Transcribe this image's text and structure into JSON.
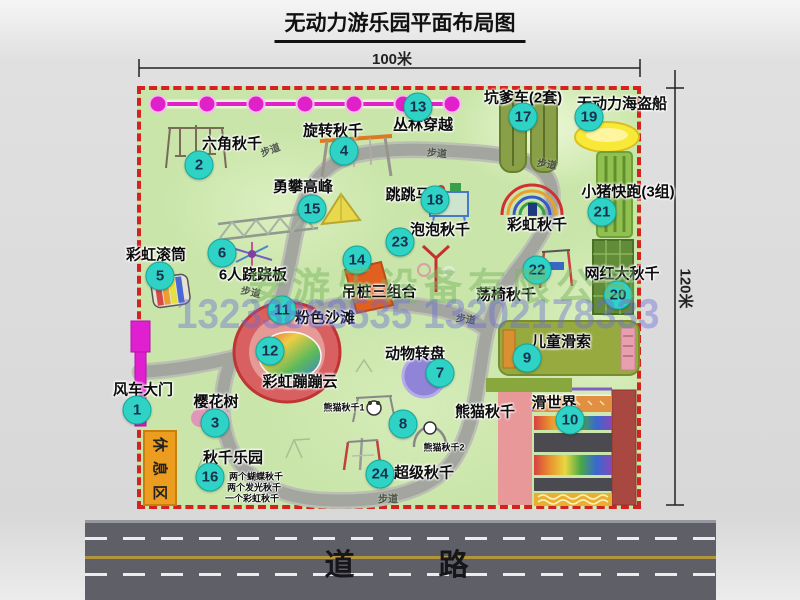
{
  "title": "无动力游乐园平面布局图",
  "dimensions": {
    "width_label": "100米",
    "height_label": "120米"
  },
  "road": {
    "label": "道　　路"
  },
  "rest_area": {
    "label": "休息区"
  },
  "watermark": {
    "company": "安游乐设备有限公司",
    "phone": "13233863535 13202178333"
  },
  "walkway_label": "步道",
  "walkway_positions": [
    {
      "x": 270,
      "y": 149,
      "r": -20
    },
    {
      "x": 437,
      "y": 152,
      "r": 5
    },
    {
      "x": 547,
      "y": 163,
      "r": 10
    },
    {
      "x": 251,
      "y": 291,
      "r": 12
    },
    {
      "x": 466,
      "y": 318,
      "r": 8
    },
    {
      "x": 388,
      "y": 498,
      "r": 0
    }
  ],
  "attractions": [
    {
      "num": "1",
      "label": "风车大门",
      "bx": 137,
      "by": 410,
      "lx": 143,
      "ly": 389
    },
    {
      "num": "2",
      "label": "六角秋千",
      "bx": 199,
      "by": 165,
      "lx": 232,
      "ly": 143
    },
    {
      "num": "3",
      "label": "樱花树",
      "bx": 215,
      "by": 423,
      "lx": 216,
      "ly": 401
    },
    {
      "num": "4",
      "label": "旋转秋千",
      "bx": 344,
      "by": 151,
      "lx": 333,
      "ly": 130
    },
    {
      "num": "5",
      "label": "彩虹滚筒",
      "bx": 160,
      "by": 276,
      "lx": 156,
      "ly": 254
    },
    {
      "num": "6",
      "label": "6人跷跷板",
      "bx": 222,
      "by": 253,
      "lx": 253,
      "ly": 274
    },
    {
      "num": "7",
      "label": "动物转盘",
      "bx": 440,
      "by": 373,
      "lx": 415,
      "ly": 353
    },
    {
      "num": "8",
      "label": "熊猫秋千",
      "bx": 403,
      "by": 424,
      "lx": 485,
      "ly": 411
    },
    {
      "num": "9",
      "label": "儿童滑索",
      "bx": 527,
      "by": 358,
      "lx": 561,
      "ly": 341
    },
    {
      "num": "10",
      "label": "滑世界",
      "bx": 570,
      "by": 420,
      "lx": 554,
      "ly": 402
    },
    {
      "num": "11",
      "label": "粉色沙滩",
      "bx": 282,
      "by": 310,
      "lx": 325,
      "ly": 317
    },
    {
      "num": "12",
      "label": "彩虹蹦蹦云",
      "bx": 270,
      "by": 351,
      "lx": 300,
      "ly": 381
    },
    {
      "num": "13",
      "label": "丛林穿越",
      "bx": 418,
      "by": 107,
      "lx": 423,
      "ly": 124
    },
    {
      "num": "14",
      "label": "吊桩三组合",
      "bx": 357,
      "by": 260,
      "lx": 379,
      "ly": 291
    },
    {
      "num": "15",
      "label": "勇攀高峰",
      "bx": 312,
      "by": 209,
      "lx": 303,
      "ly": 186
    },
    {
      "num": "16",
      "label": "秋千乐园",
      "bx": 210,
      "by": 477,
      "lx": 233,
      "ly": 457
    },
    {
      "num": "17",
      "label": "坑爹车(2套)",
      "bx": 523,
      "by": 117,
      "lx": 523,
      "ly": 97
    },
    {
      "num": "18",
      "label": "跳跳马",
      "bx": 435,
      "by": 200,
      "lx": 408,
      "ly": 194
    },
    {
      "num": "19",
      "label": "无动力海盗船",
      "bx": 589,
      "by": 117,
      "lx": 622,
      "ly": 103
    },
    {
      "num": "20",
      "label": "网红大秋千",
      "bx": 618,
      "by": 295,
      "lx": 622,
      "ly": 273
    },
    {
      "num": "21",
      "label": "小猪快跑(3组)",
      "bx": 602,
      "by": 212,
      "lx": 628,
      "ly": 191
    },
    {
      "num": "22",
      "label": "荡椅秋千",
      "bx": 537,
      "by": 270,
      "lx": 506,
      "ly": 294
    },
    {
      "num": "23",
      "label": "泡泡秋千",
      "bx": 400,
      "by": 242,
      "lx": 440,
      "ly": 229
    },
    {
      "num": "24",
      "label": "超级秋千",
      "bx": 380,
      "by": 474,
      "lx": 424,
      "ly": 472
    }
  ],
  "extra_labels": [
    {
      "id": "rainbow-swing-label",
      "text": "彩虹秋千",
      "x": 537,
      "y": 224,
      "size": 15
    },
    {
      "id": "panda-swing-1-label",
      "text": "熊猫秋千1",
      "x": 344,
      "y": 407,
      "size": 9
    },
    {
      "id": "panda-swing-2-label",
      "text": "熊猫秋千2",
      "x": 444,
      "y": 447,
      "size": 9
    },
    {
      "id": "swing-park-note-1",
      "text": "两个蝴蝶秋千",
      "x": 256,
      "y": 476,
      "size": 9
    },
    {
      "id": "swing-park-note-2",
      "text": "两个发光秋千",
      "x": 254,
      "y": 487,
      "size": 9
    },
    {
      "id": "swing-park-note-3",
      "text": "一个彩虹秋千",
      "x": 252,
      "y": 498,
      "size": 9
    }
  ],
  "colors": {
    "map_green": "#c9e5a9",
    "border_red": "#d42121",
    "badge_teal": "#2fd3c6",
    "magenta": "#e020c8",
    "road_gray": "#5f5f68",
    "path_gray": "#a2a69e",
    "rest_orange": "#ec9c1e"
  }
}
